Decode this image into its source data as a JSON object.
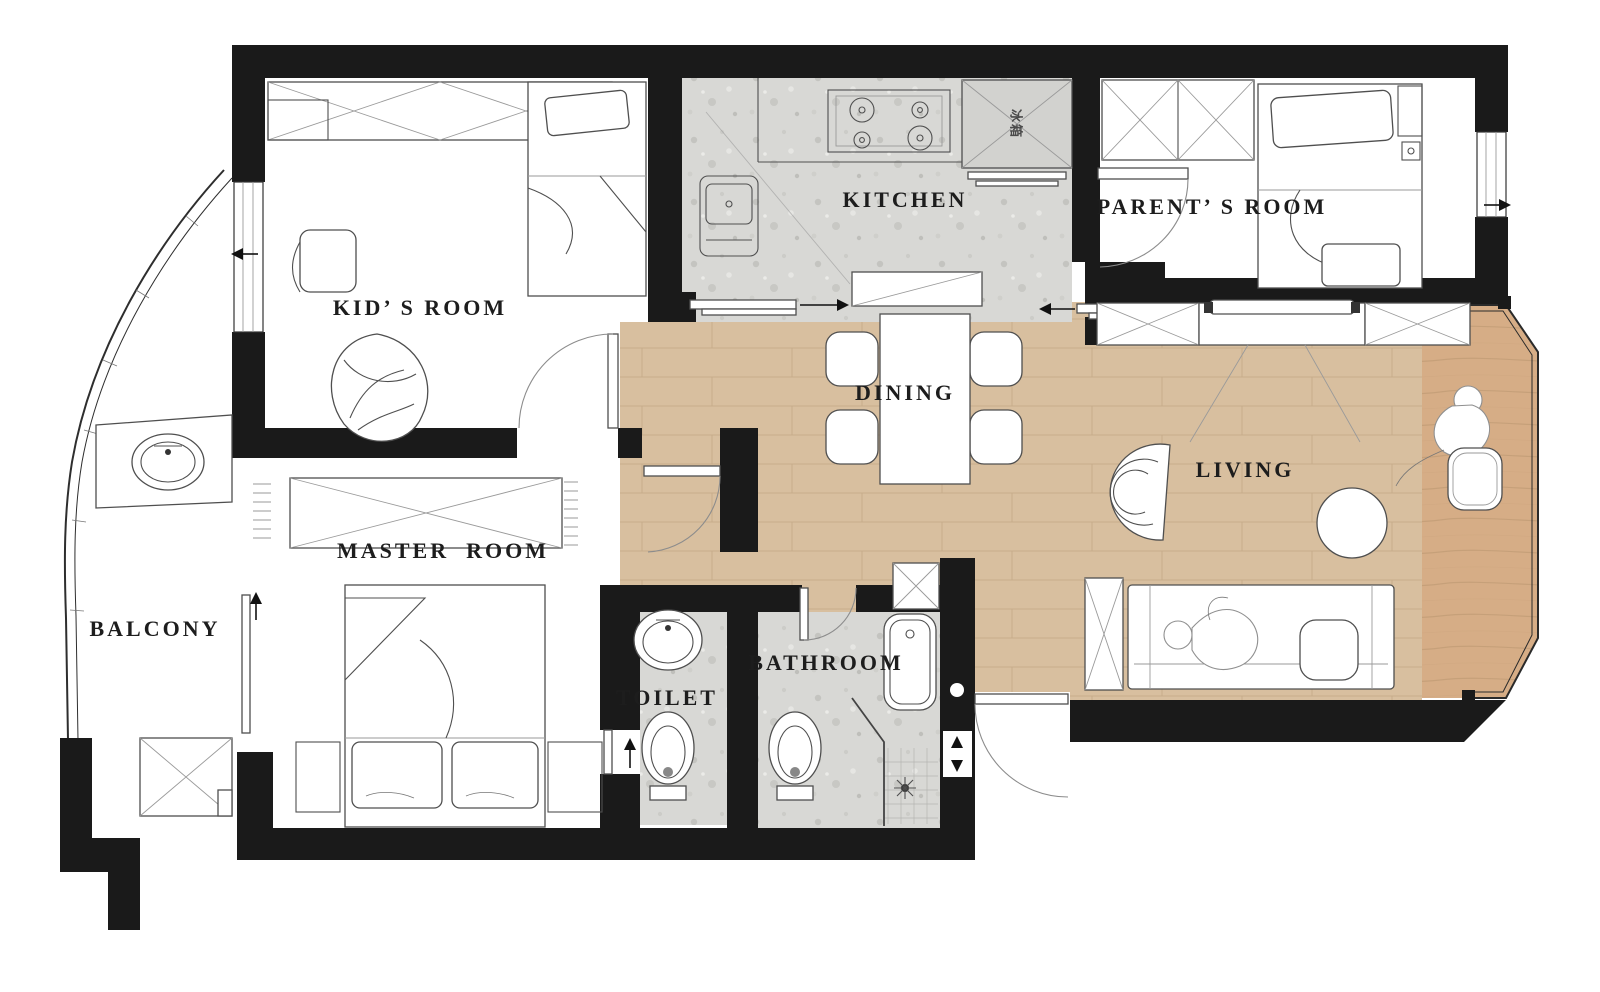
{
  "colors": {
    "wall": "#1a1a1a",
    "wood": "#d8bf9f",
    "wood-dark": "#d6ad86",
    "tile": "#d8d8d5",
    "label": "#1d1d1d"
  },
  "rooms": [
    {
      "id": "kids-room",
      "label": "KID’ S ROOM"
    },
    {
      "id": "kitchen",
      "label": "KITCHEN"
    },
    {
      "id": "parents-room",
      "label": "PARENT’ S ROOM"
    },
    {
      "id": "dining",
      "label": "DINING"
    },
    {
      "id": "living",
      "label": "LIVING"
    },
    {
      "id": "master-room",
      "label": "MASTER  ROOM"
    },
    {
      "id": "balcony",
      "label": "BALCONY"
    },
    {
      "id": "toilet",
      "label": "TOILET"
    },
    {
      "id": "bathroom",
      "label": "BATHROOM"
    }
  ],
  "annotations": {
    "fridge": "冰箱"
  },
  "fixtures": [
    "wardrobe-icon",
    "single-bed-icon",
    "double-bed-icon",
    "desk-chair-icon",
    "bean-bag-icon",
    "stove-icon",
    "kitchen-sink-icon",
    "fridge-icon",
    "dining-table-icon",
    "dining-chair-icon",
    "console-icon",
    "tv-icon",
    "tv-cabinet-icon",
    "lounge-chair-icon",
    "round-table-icon",
    "sofa-icon",
    "pouf-icon",
    "person-icon",
    "basin-icon",
    "wc-icon",
    "bathtub-icon",
    "shower-icon",
    "washing-machine-icon",
    "balcony-sink-icon",
    "mirror-board-icon",
    "storage-cabinet-icon",
    "door-swing-icon",
    "sliding-door-icon",
    "window-icon",
    "direction-arrow-icon"
  ]
}
